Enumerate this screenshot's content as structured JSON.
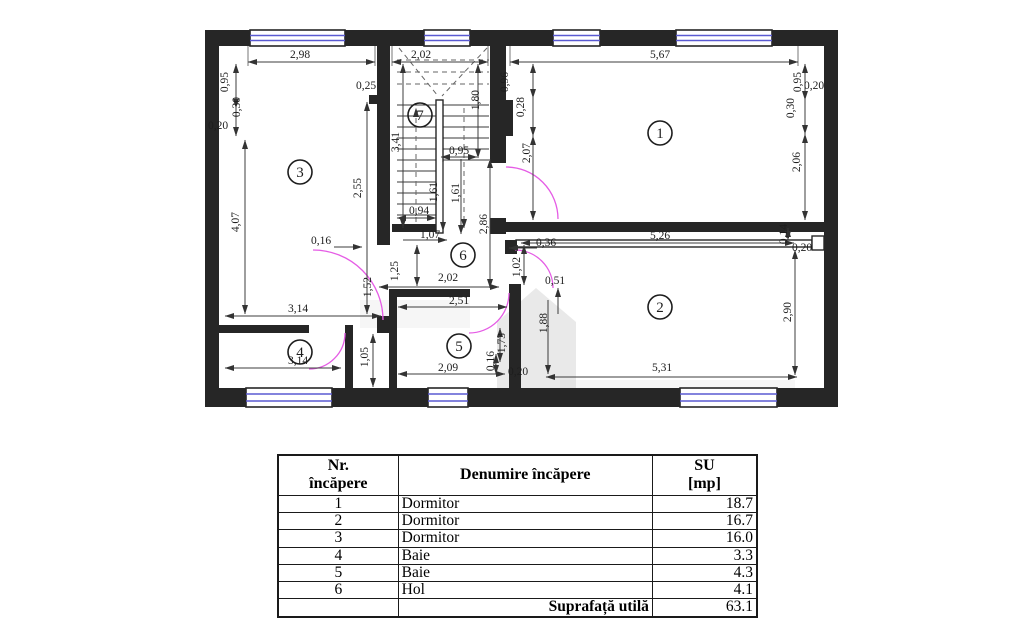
{
  "plan": {
    "wall_color": "#262626",
    "window_color": "#5a5ad2",
    "door_color": "#e55ce5",
    "rooms": [
      {
        "number": "1",
        "x": 660,
        "y": 133
      },
      {
        "number": "2",
        "x": 660,
        "y": 307
      },
      {
        "number": "3",
        "x": 300,
        "y": 172
      },
      {
        "number": "4",
        "x": 300,
        "y": 352
      },
      {
        "number": "5",
        "x": 459,
        "y": 346
      },
      {
        "number": "6",
        "x": 463,
        "y": 255
      },
      {
        "number": "7",
        "x": 420,
        "y": 115
      }
    ],
    "dimensions": [
      {
        "text": "2,98",
        "x": 300,
        "y": 58
      },
      {
        "text": "2,02",
        "x": 421,
        "y": 58
      },
      {
        "text": "5,67",
        "x": 660,
        "y": 58
      },
      {
        "text": "0,95",
        "x": 228,
        "y": 82,
        "rot": true
      },
      {
        "text": "0,30",
        "x": 240,
        "y": 107,
        "rot": true
      },
      {
        "text": "0,20",
        "x": 218,
        "y": 129
      },
      {
        "text": "4,07",
        "x": 239,
        "y": 222,
        "rot": true
      },
      {
        "text": "0,25",
        "x": 366,
        "y": 89
      },
      {
        "text": "2,55",
        "x": 361,
        "y": 188,
        "rot": true
      },
      {
        "text": "1,80",
        "x": 479,
        "y": 100,
        "rot": true
      },
      {
        "text": "3,41",
        "x": 399,
        "y": 142,
        "rot": true
      },
      {
        "text": "0,95",
        "x": 459,
        "y": 154
      },
      {
        "text": "1,61",
        "x": 437,
        "y": 192,
        "rot": true
      },
      {
        "text": "1,61",
        "x": 459,
        "y": 193,
        "rot": true
      },
      {
        "text": "0,94",
        "x": 419,
        "y": 214
      },
      {
        "text": "1,07",
        "x": 430,
        "y": 238
      },
      {
        "text": "2,86",
        "x": 487,
        "y": 224,
        "rot": true
      },
      {
        "text": "1,25",
        "x": 398,
        "y": 271,
        "rot": true
      },
      {
        "text": "2,02",
        "x": 448,
        "y": 281
      },
      {
        "text": "0,16",
        "x": 321,
        "y": 244
      },
      {
        "text": "1,52",
        "x": 371,
        "y": 287,
        "rot": true
      },
      {
        "text": "1,02",
        "x": 520,
        "y": 267,
        "rot": true
      },
      {
        "text": "0,36",
        "x": 546,
        "y": 246
      },
      {
        "text": "0,51",
        "x": 555,
        "y": 284
      },
      {
        "text": "0,96",
        "x": 508,
        "y": 82,
        "rot": true
      },
      {
        "text": "0,28",
        "x": 524,
        "y": 107,
        "rot": true
      },
      {
        "text": "2,07",
        "x": 530,
        "y": 153,
        "rot": true
      },
      {
        "text": "0,95",
        "x": 801,
        "y": 82,
        "rot": true
      },
      {
        "text": "0,20",
        "x": 814,
        "y": 89
      },
      {
        "text": "0,30",
        "x": 794,
        "y": 108,
        "rot": true
      },
      {
        "text": "2,06",
        "x": 800,
        "y": 162,
        "rot": true
      },
      {
        "text": "5,26",
        "x": 660,
        "y": 239
      },
      {
        "text": "0,14",
        "x": 787,
        "y": 234,
        "rot": true
      },
      {
        "text": "0,20",
        "x": 802,
        "y": 251
      },
      {
        "text": "1,88",
        "x": 547,
        "y": 323,
        "rot": true
      },
      {
        "text": "2,90",
        "x": 791,
        "y": 312,
        "rot": true
      },
      {
        "text": "5,31",
        "x": 662,
        "y": 371
      },
      {
        "text": "2,51",
        "x": 459,
        "y": 304
      },
      {
        "text": "1,73",
        "x": 505,
        "y": 343,
        "rot": true
      },
      {
        "text": "0,16",
        "x": 494,
        "y": 361,
        "rot": true
      },
      {
        "text": "2,09",
        "x": 448,
        "y": 371
      },
      {
        "text": "0,20",
        "x": 518,
        "y": 375
      },
      {
        "text": "3,14",
        "x": 298,
        "y": 312
      },
      {
        "text": "3,14",
        "x": 298,
        "y": 364
      },
      {
        "text": "1,05",
        "x": 368,
        "y": 357,
        "rot": true
      }
    ]
  },
  "table": {
    "header": {
      "col1_line1": "Nr.",
      "col1_line2": "încăpere",
      "col2": "Denumire încăpere",
      "col3_line1": "SU",
      "col3_line2": "[mp]"
    },
    "rows": [
      {
        "nr": "1",
        "name": "Dormitor",
        "su": "18.7"
      },
      {
        "nr": "2",
        "name": "Dormitor",
        "su": "16.7"
      },
      {
        "nr": "3",
        "name": "Dormitor",
        "su": "16.0"
      },
      {
        "nr": "4",
        "name": "Baie",
        "su": "3.3"
      },
      {
        "nr": "5",
        "name": "Baie",
        "su": "4.3"
      },
      {
        "nr": "6",
        "name": "Hol",
        "su": "4.1"
      }
    ],
    "footer": {
      "label": "Suprafață utilă",
      "value": "63.1"
    }
  }
}
